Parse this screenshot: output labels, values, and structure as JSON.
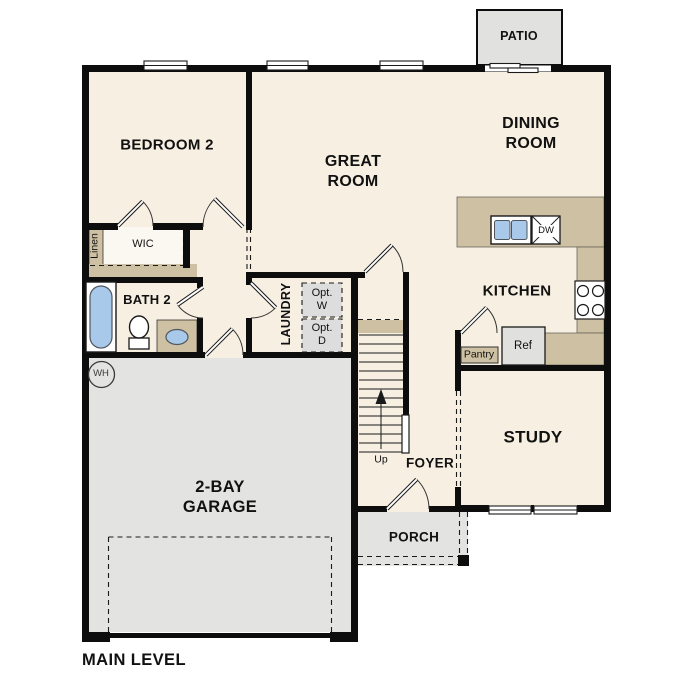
{
  "title": "MAIN LEVEL",
  "rooms": {
    "bedroom2": "BEDROOM 2",
    "great_room": "GREAT\nROOM",
    "dining_room": "DINING\nROOM",
    "kitchen": "KITCHEN",
    "study": "STUDY",
    "foyer": "FOYER",
    "laundry": "LAUNDRY",
    "bath2": "BATH 2",
    "wic": "WIC",
    "garage": "2-BAY\nGARAGE",
    "porch": "PORCH",
    "patio": "PATIO"
  },
  "fixtures": {
    "linen": "Linen",
    "opt_washer": "Opt.\nW",
    "opt_dryer": "Opt.\nD",
    "pantry": "Pantry",
    "refrigerator": "Ref",
    "dishwasher": "DW",
    "stairs_direction": "Up",
    "water_heater": "WH"
  },
  "colors": {
    "floor_cream": "#f7efe1",
    "closet_white": "#fbf8f1",
    "counter_tan": "#cec0a2",
    "concrete_gray": "#e3e3e1",
    "appliance_gray": "#dcdddc",
    "plumbing_blue": "#a9c9eb",
    "wall_black": "#0d0d0d"
  }
}
